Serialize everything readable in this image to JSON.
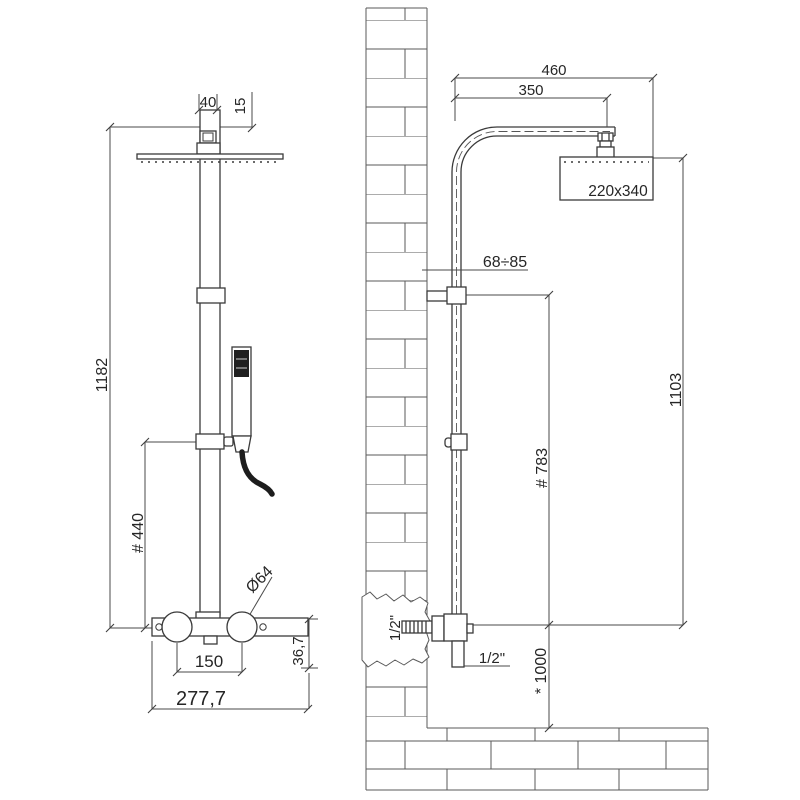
{
  "front_view": {
    "head_width": "40",
    "head_offset": "15",
    "total_height": "1182",
    "handset_height": "# 440",
    "knob_diameter": "Ø64",
    "knob_spacing": "150",
    "body_width": "277,7",
    "body_height": "36,7"
  },
  "side_view": {
    "arm_total": "460",
    "arm_reach": "350",
    "head_size": "220x340",
    "bracket_range": "68÷85",
    "bracket_to_valve": "# 783",
    "column_height": "1103",
    "wall_thread": "1/2\"",
    "hose_thread": "1/2\"",
    "valve_floor_height": "* 1000"
  },
  "colors": {
    "line": "#3a3a3a",
    "dimension_line": "#4a4a4a",
    "brick": "#5a5a5a",
    "text": "#262626",
    "dark_fill": "#1f1f1f",
    "background": "#ffffff"
  }
}
